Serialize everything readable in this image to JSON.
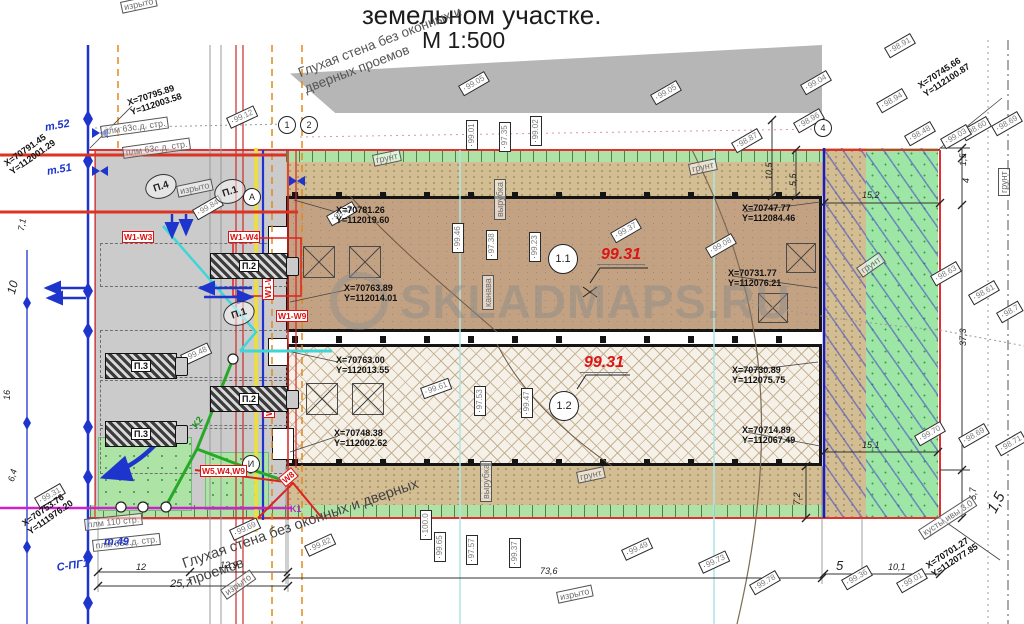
{
  "title": {
    "line1": "земельном участке.",
    "line2": "М 1:500"
  },
  "watermark": {
    "text": "SKLADMAPS.RU"
  },
  "wall_notes": {
    "top": "Глухая стена без оконных и дверных проемов",
    "bottom": "Глухая стена без оконных и дверных проемов"
  },
  "building_marks": {
    "upper_circle": "1.1",
    "lower_circle": "1.2",
    "upper_elev": "99.31",
    "lower_elev": "99.31"
  },
  "well_label": "И",
  "axis_markers": [
    {
      "t": "1",
      "x": 278,
      "y": 116
    },
    {
      "t": "2",
      "x": 300,
      "y": 116
    },
    {
      "t": "4",
      "x": 814,
      "y": 119
    },
    {
      "t": "А",
      "x": 243,
      "y": 188
    }
  ],
  "parking_markers": [
    {
      "t": "П.4",
      "x": 142,
      "y": 180
    },
    {
      "t": "П.1",
      "x": 211,
      "y": 185
    },
    {
      "t": "П.1",
      "x": 220,
      "y": 307
    }
  ],
  "trucks": [
    {
      "label": "П.2",
      "x": 210,
      "y": 253,
      "w": 76,
      "h": 24
    },
    {
      "label": "П.3",
      "x": 105,
      "y": 353,
      "w": 70,
      "h": 24
    },
    {
      "label": "П.2",
      "x": 210,
      "y": 386,
      "w": 76,
      "h": 24
    },
    {
      "label": "П.3",
      "x": 105,
      "y": 421,
      "w": 70,
      "h": 24
    }
  ],
  "coords": [
    {
      "x_label": "X=70795.89",
      "y_label": "Y=112003.58",
      "x": 126,
      "y": 98,
      "r": -18
    },
    {
      "x_label": "X=70791.45",
      "y_label": "Y=112001.29",
      "x": 2,
      "y": 160,
      "r": -35
    },
    {
      "x_label": "X=70781.26",
      "y_label": "Y=112019.60",
      "x": 336,
      "y": 205,
      "r": 0
    },
    {
      "x_label": "X=70763.89",
      "y_label": "Y=112014.01",
      "x": 344,
      "y": 283,
      "r": 0
    },
    {
      "x_label": "X=70763.00",
      "y_label": "Y=112013.55",
      "x": 336,
      "y": 355,
      "r": 0
    },
    {
      "x_label": "X=70748.38",
      "y_label": "Y=112002.62",
      "x": 334,
      "y": 428,
      "r": 0
    },
    {
      "x_label": "X=70753.76",
      "y_label": "Y=111976.20",
      "x": 20,
      "y": 520,
      "r": -35
    },
    {
      "x_label": "X=70747.77",
      "y_label": "Y=112084.46",
      "x": 742,
      "y": 203,
      "r": 0
    },
    {
      "x_label": "X=70731.77",
      "y_label": "Y=112076.21",
      "x": 728,
      "y": 268,
      "r": 0
    },
    {
      "x_label": "X=70730.89",
      "y_label": "Y=112075.75",
      "x": 732,
      "y": 365,
      "r": 0
    },
    {
      "x_label": "X=70714.89",
      "y_label": "Y=112067.49",
      "x": 742,
      "y": 425,
      "r": 0
    },
    {
      "x_label": "X=70745.66",
      "y_label": "Y=112100.87",
      "x": 916,
      "y": 82,
      "r": -33
    },
    {
      "x_label": "X=70701.27",
      "y_label": "Y=112077.85",
      "x": 924,
      "y": 562,
      "r": -33
    }
  ],
  "elevations": [
    {
      "v": "99.12",
      "x": 226,
      "y": 118,
      "r": -25
    },
    {
      "v": "99.05",
      "x": 458,
      "y": 86,
      "r": -30
    },
    {
      "v": "99.05",
      "x": 650,
      "y": 95,
      "r": -30
    },
    {
      "v": "99.04",
      "x": 800,
      "y": 85,
      "r": -30
    },
    {
      "v": "98.87",
      "x": 731,
      "y": 143,
      "r": -30
    },
    {
      "v": "98.96",
      "x": 793,
      "y": 123,
      "r": -30
    },
    {
      "v": "98.91",
      "x": 884,
      "y": 48,
      "r": -30
    },
    {
      "v": "98.94",
      "x": 876,
      "y": 103,
      "r": -30
    },
    {
      "v": "98.48",
      "x": 904,
      "y": 136,
      "r": -30
    },
    {
      "v": "98.60",
      "x": 960,
      "y": 131,
      "r": -30
    },
    {
      "v": "98.69",
      "x": 991,
      "y": 126,
      "r": -30
    },
    {
      "v": "99.03",
      "x": 940,
      "y": 139,
      "r": -30
    },
    {
      "v": "99.01",
      "x": 466,
      "y": 150,
      "r": -90
    },
    {
      "v": "97.35",
      "x": 499,
      "y": 152,
      "r": -90
    },
    {
      "v": "99.02",
      "x": 530,
      "y": 146,
      "r": -90
    },
    {
      "v": "98.43",
      "x": 326,
      "y": 216,
      "r": -30
    },
    {
      "v": "99.46",
      "x": 452,
      "y": 253,
      "r": -90
    },
    {
      "v": "97.38",
      "x": 486,
      "y": 260,
      "r": -90
    },
    {
      "v": "99.23",
      "x": 529,
      "y": 262,
      "r": -90
    },
    {
      "v": "99.37",
      "x": 610,
      "y": 233,
      "r": -30
    },
    {
      "v": "99.08",
      "x": 705,
      "y": 248,
      "r": -30
    },
    {
      "v": "99.84",
      "x": 192,
      "y": 210,
      "r": -30
    },
    {
      "v": "99.48",
      "x": 180,
      "y": 355,
      "r": -25
    },
    {
      "v": "99.61",
      "x": 420,
      "y": 388,
      "r": -20
    },
    {
      "v": "97.53",
      "x": 474,
      "y": 416,
      "r": -90
    },
    {
      "v": "99.47",
      "x": 521,
      "y": 418,
      "r": -90
    },
    {
      "v": "98.63",
      "x": 930,
      "y": 276,
      "r": -30
    },
    {
      "v": "98.61",
      "x": 968,
      "y": 295,
      "r": -30
    },
    {
      "v": "98.7",
      "x": 996,
      "y": 313,
      "r": -30
    },
    {
      "v": "99.70",
      "x": 914,
      "y": 436,
      "r": -30
    },
    {
      "v": "98.69",
      "x": 958,
      "y": 438,
      "r": -30
    },
    {
      "v": "98.71",
      "x": 995,
      "y": 446,
      "r": -30
    },
    {
      "v": "99.69",
      "x": 229,
      "y": 530,
      "r": -25
    },
    {
      "v": "99.82",
      "x": 304,
      "y": 546,
      "r": -25
    },
    {
      "v": "100.0",
      "x": 420,
      "y": 540,
      "r": -90
    },
    {
      "v": "99.65",
      "x": 434,
      "y": 562,
      "r": -90
    },
    {
      "v": "97.57",
      "x": 466,
      "y": 565,
      "r": -90
    },
    {
      "v": "99.37",
      "x": 509,
      "y": 568,
      "r": -90
    },
    {
      "v": "99.49",
      "x": 621,
      "y": 550,
      "r": -25
    },
    {
      "v": "99.73",
      "x": 698,
      "y": 563,
      "r": -25
    },
    {
      "v": "99.78",
      "x": 749,
      "y": 585,
      "r": -30
    },
    {
      "v": "99.36",
      "x": 841,
      "y": 580,
      "r": -30
    },
    {
      "v": "99.01",
      "x": 896,
      "y": 583,
      "r": -30
    },
    {
      "v": "99.31",
      "x": 34,
      "y": 498,
      "r": -30
    }
  ],
  "dims": [
    {
      "t": "15,2",
      "x": 862,
      "y": 190,
      "r": 0
    },
    {
      "t": "15,1",
      "x": 862,
      "y": 440,
      "r": 0
    },
    {
      "t": "73,6",
      "x": 540,
      "y": 566,
      "r": 0
    },
    {
      "t": "12",
      "x": 136,
      "y": 562,
      "r": 0
    },
    {
      "t": "12,9",
      "x": 220,
      "y": 560,
      "r": 0
    },
    {
      "t": "25,7",
      "x": 170,
      "y": 578,
      "r": 0,
      "s": 11
    },
    {
      "t": "5",
      "x": 836,
      "y": 558,
      "r": 0,
      "s": 13
    },
    {
      "t": "10,1",
      "x": 888,
      "y": 562,
      "r": 0
    },
    {
      "t": "10,5",
      "x": 764,
      "y": 180,
      "r": -90
    },
    {
      "t": "5,5",
      "x": 788,
      "y": 186,
      "r": -90
    },
    {
      "t": "1,5",
      "x": 958,
      "y": 166,
      "r": -90
    },
    {
      "t": "4",
      "x": 961,
      "y": 183,
      "r": -90
    },
    {
      "t": "37,3",
      "x": 958,
      "y": 346,
      "r": -90
    },
    {
      "t": "5,7",
      "x": 968,
      "y": 500,
      "r": -90
    },
    {
      "t": "7,2",
      "x": 792,
      "y": 505,
      "r": -90
    },
    {
      "t": "1,5",
      "x": 984,
      "y": 508,
      "r": -62,
      "s": 15
    },
    {
      "t": "10",
      "x": 4,
      "y": 292,
      "r": -75,
      "s": 12
    },
    {
      "t": "6,4",
      "x": 6,
      "y": 480,
      "r": -75
    },
    {
      "t": "7,1",
      "x": 16,
      "y": 230,
      "r": -80
    },
    {
      "t": "16",
      "x": 2,
      "y": 400,
      "r": -90
    }
  ],
  "notes": [
    {
      "t": "плм 63с.д. стр.",
      "x": 100,
      "y": 126,
      "r": -8
    },
    {
      "t": "плм 63с.д. стр.",
      "x": 122,
      "y": 147,
      "r": -8
    },
    {
      "t": "изрыто",
      "x": 176,
      "y": 186,
      "r": -12
    },
    {
      "t": "изрыто",
      "x": 120,
      "y": 2,
      "r": -12
    },
    {
      "t": "изрыто",
      "x": 220,
      "y": 590,
      "r": -35
    },
    {
      "t": "изрыто",
      "x": 556,
      "y": 592,
      "r": -12
    },
    {
      "t": "грунт",
      "x": 372,
      "y": 155,
      "r": -12
    },
    {
      "t": "грунт",
      "x": 688,
      "y": 164,
      "r": -12
    },
    {
      "t": "грунт",
      "x": 856,
      "y": 268,
      "r": -35
    },
    {
      "t": "грунт",
      "x": 576,
      "y": 472,
      "r": -12
    },
    {
      "t": "грунт",
      "x": 998,
      "y": 196,
      "r": -90
    },
    {
      "t": "канава",
      "x": 482,
      "y": 310,
      "r": -90
    },
    {
      "t": "вырубка",
      "x": 494,
      "y": 220,
      "r": -90
    },
    {
      "t": "вырубка",
      "x": 480,
      "y": 502,
      "r": -90
    },
    {
      "t": "кусты ивы 3.0",
      "x": 918,
      "y": 530,
      "r": -33
    },
    {
      "t": "плм 110 стр.",
      "x": 84,
      "y": 519,
      "r": -6
    },
    {
      "t": "плм 63с.д. стр.",
      "x": 92,
      "y": 540,
      "r": -6
    }
  ],
  "utility_labels": [
    {
      "t": "W1-W3",
      "x": 122,
      "y": 231,
      "r": 0,
      "c": "red"
    },
    {
      "t": "W1-W4",
      "x": 228,
      "y": 231,
      "r": 0,
      "c": "red"
    },
    {
      "t": "W1-W9",
      "x": 276,
      "y": 310,
      "r": 0,
      "c": "red"
    },
    {
      "t": "W1-W9",
      "x": 262,
      "y": 300,
      "r": -90,
      "c": "red"
    },
    {
      "t": "W1-W9",
      "x": 263,
      "y": 418,
      "r": -90,
      "c": "red"
    },
    {
      "t": "W5,W4,W9",
      "x": 200,
      "y": 465,
      "r": 0,
      "c": "red"
    },
    {
      "t": "W8",
      "x": 278,
      "y": 478,
      "r": -40,
      "c": "red"
    },
    {
      "t": "K1",
      "x": 290,
      "y": 504,
      "r": 0,
      "c": "magenta"
    },
    {
      "t": "K2",
      "x": 190,
      "y": 424,
      "r": -55,
      "c": "green"
    },
    {
      "t": "т.52",
      "x": 44,
      "y": 122,
      "r": -10,
      "c": "blue"
    },
    {
      "t": "т.51",
      "x": 46,
      "y": 166,
      "r": -10,
      "c": "blue"
    },
    {
      "t": "т.49",
      "x": 104,
      "y": 536,
      "r": 0,
      "c": "blue"
    },
    {
      "t": "С-ПГ1",
      "x": 56,
      "y": 562,
      "r": -8,
      "c": "blue"
    }
  ]
}
